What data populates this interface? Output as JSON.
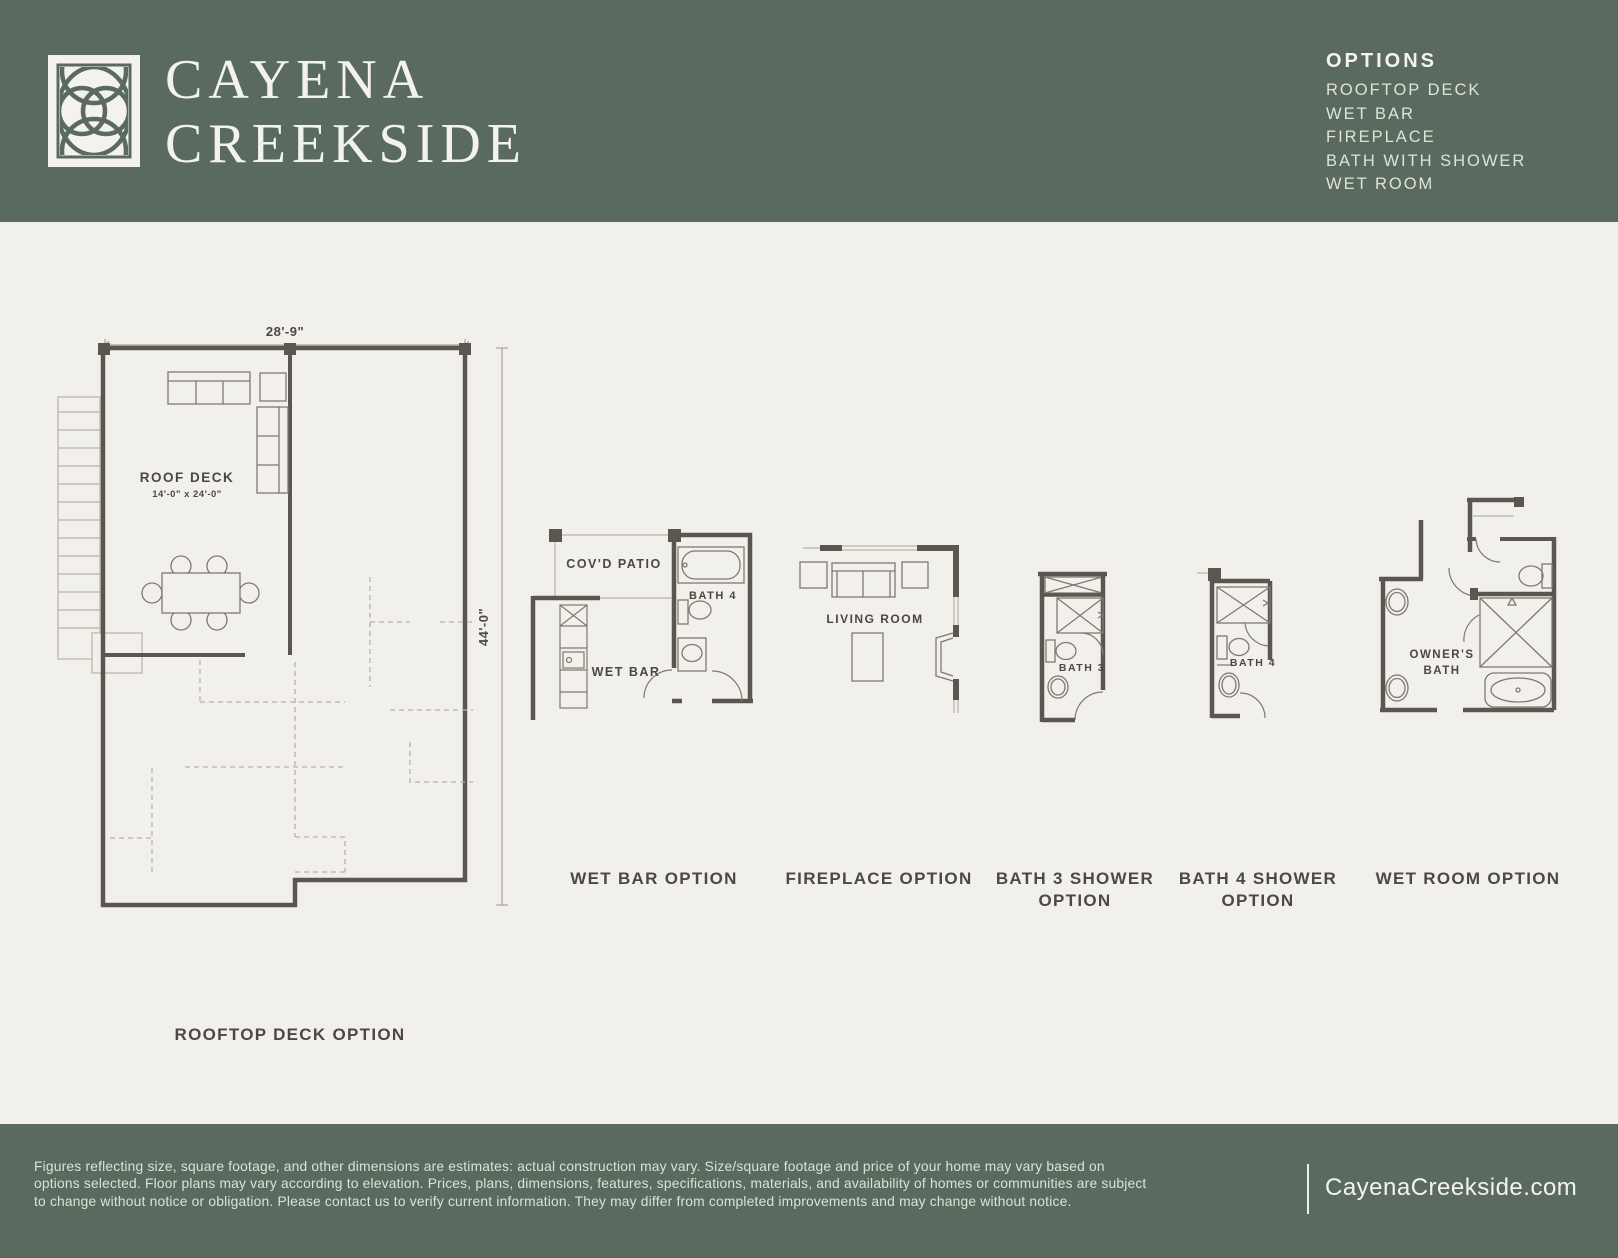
{
  "theme": {
    "green": "#5a6a5f",
    "cream": "#f2f0ea",
    "wall": "#5b5750",
    "label": "#4b4842"
  },
  "header": {
    "brand_line1": "CAYENA",
    "brand_line2": "CREEKSIDE",
    "options_title": "OPTIONS",
    "options": [
      "ROOFTOP DECK",
      "WET BAR",
      "FIREPLACE",
      "BATH WITH SHOWER",
      "WET ROOM"
    ]
  },
  "plans": {
    "rooftop": {
      "caption": "ROOFTOP DECK OPTION",
      "dim_width": "28'-9\"",
      "dim_height": "44'-0\"",
      "room": "ROOF DECK",
      "room_size": "14'-0\" x 24'-0\""
    },
    "wet_bar": {
      "caption": "WET BAR OPTION",
      "patio": "COV'D PATIO",
      "bath": "BATH 4",
      "bar": "WET BAR"
    },
    "fireplace": {
      "caption": "FIREPLACE OPTION",
      "living": "LIVING ROOM"
    },
    "bath3": {
      "caption_line1": "BATH 3 SHOWER",
      "caption_line2": "OPTION",
      "label": "BATH 3"
    },
    "bath4": {
      "caption_line1": "BATH 4 SHOWER",
      "caption_line2": "OPTION",
      "label": "BATH 4"
    },
    "wet_room": {
      "caption": "WET ROOM OPTION",
      "owner_line1": "OWNER'S",
      "owner_line2": "BATH"
    }
  },
  "footer": {
    "disclaimer_line1": "Figures reflecting size, square footage, and other dimensions are estimates: actual construction may vary. Size/square footage and price of your home may vary based on",
    "disclaimer_line2": "options selected. Floor plans may vary according to elevation. Prices, plans, dimensions, features, specifications, materials, and availability of homes or communities are subject",
    "disclaimer_line3": "to change without notice or obligation. Please contact us to verify current information. They may differ from completed improvements and may change without notice.",
    "website": "CayenaCreekside.com"
  }
}
